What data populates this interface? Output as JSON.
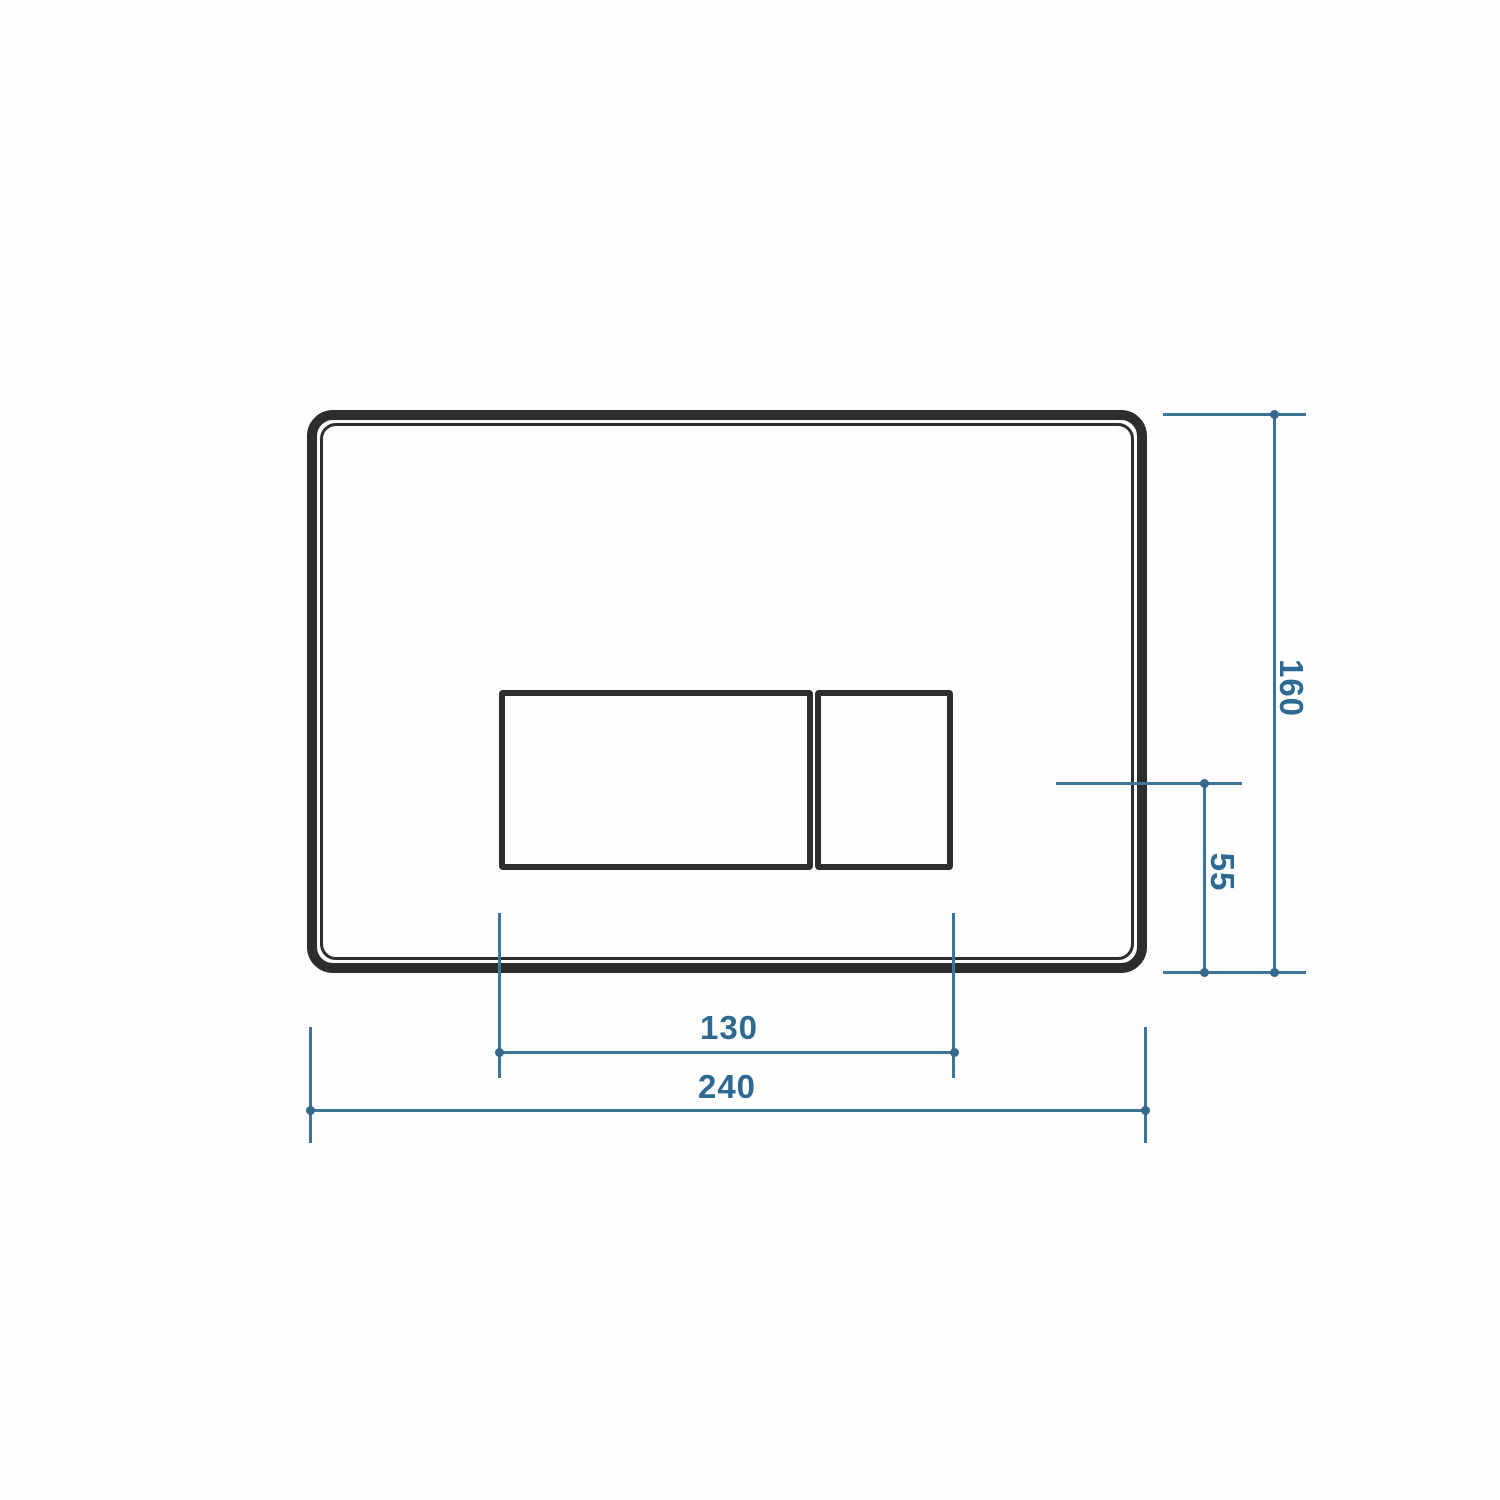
{
  "drawing": {
    "type": "technical-dimension-drawing",
    "subject": "dual-flush toilet wall plate, front elevation",
    "labels": {
      "overall_width": "240",
      "overall_height": "160",
      "button_group_width": "130",
      "button_centerline_offset": "55"
    },
    "colors": {
      "outline": "#2b2d2e",
      "dimension_line": "#3d7499",
      "dimension_text": "#2c6a94",
      "background": "#fdfdfd"
    }
  }
}
